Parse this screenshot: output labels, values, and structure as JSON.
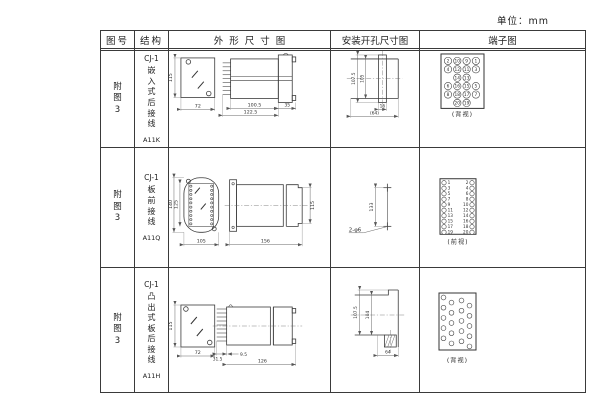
{
  "unit_label": "单位：mm",
  "header": {
    "fig": "图号",
    "struct": "结构",
    "outline": "外形尺寸图",
    "mount": "安装开孔尺寸图",
    "terminal": "端子图"
  },
  "rows": [
    {
      "fig": "附图3",
      "struct_model": "CJ-1",
      "struct_text": "嵌入式后接线",
      "struct_code": "A11K",
      "outline_dims": {
        "front_height": "115",
        "front_width": "72",
        "body_len": "100.5",
        "total_len": "122.5",
        "flange": "35"
      },
      "mount_dims": {
        "slot_height": "107.5",
        "cutout_height": "105",
        "slot_width": "16",
        "cutout_width": "(64)"
      },
      "terminal": {
        "caption": "(背视)",
        "grid": [
          [
            "2",
            "10",
            "9",
            "1"
          ],
          [
            "4",
            "12",
            "11",
            "3"
          ],
          [
            "",
            "14",
            "13",
            ""
          ],
          [
            "6",
            "16",
            "15",
            "5"
          ],
          [
            "8",
            "18",
            "17",
            "7"
          ],
          [
            "",
            "20",
            "19",
            ""
          ]
        ]
      }
    },
    {
      "fig": "附图3",
      "struct_model": "CJ-1",
      "struct_text": "板前接线",
      "struct_code": "A11Q",
      "outline_dims": {
        "outer_height": "140",
        "inner_height": "125",
        "front_width": "105",
        "total_len": "156",
        "side_height": "115"
      },
      "mount_dims": {
        "hole_spacing": "133",
        "holes": "2-φ6"
      },
      "terminal": {
        "caption": "(前视)",
        "left_nums": [
          "1",
          "3",
          "5",
          "7",
          "9",
          "11",
          "13",
          "15",
          "17",
          "19"
        ],
        "right_nums": [
          "2",
          "4",
          "6",
          "8",
          "10",
          "12",
          "14",
          "16",
          "18",
          "20"
        ]
      }
    },
    {
      "fig": "附图3",
      "struct_model": "CJ-1",
      "struct_text": "凸出式板后接线",
      "struct_code": "A11H",
      "outline_dims": {
        "front_height": "115",
        "front_width": "72",
        "pin_zone": "31.5",
        "pin_len": "9.5",
        "total_len": "126"
      },
      "mount_dims": {
        "outer_height": "107.5",
        "inner_height": "104",
        "width": "64"
      },
      "terminal": {
        "caption": "(背视)"
      }
    }
  ]
}
